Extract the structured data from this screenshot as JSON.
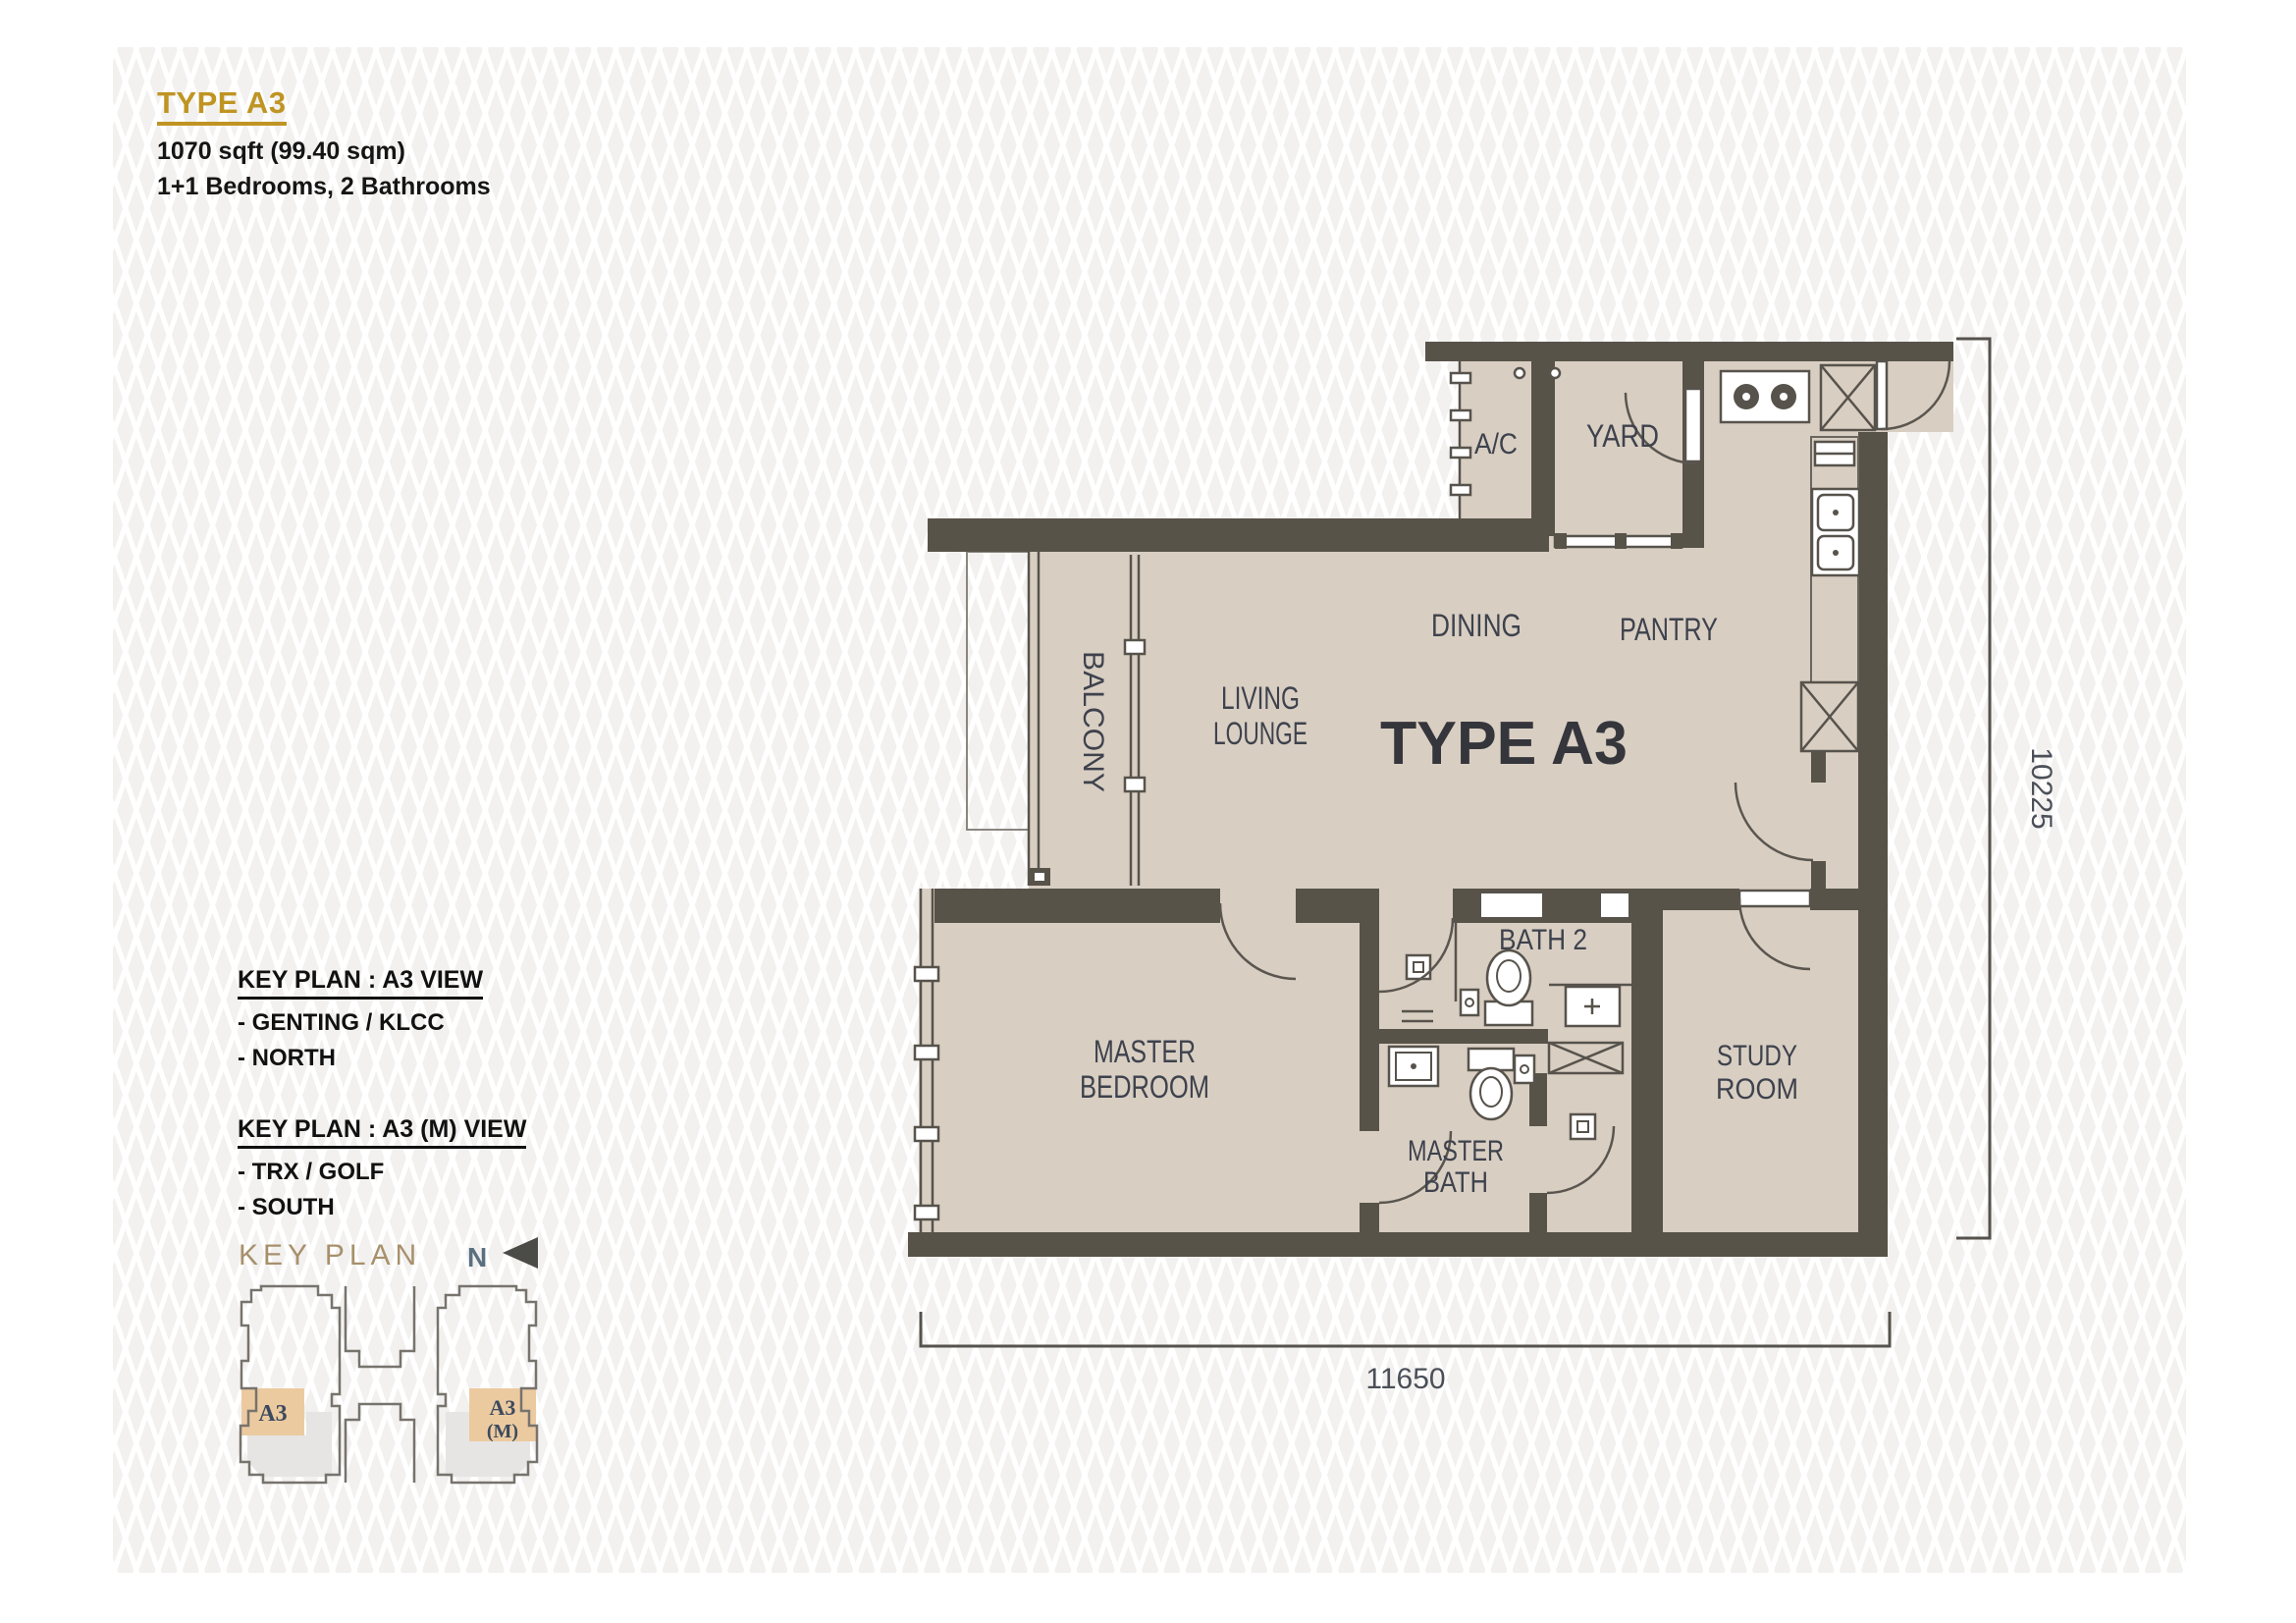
{
  "header": {
    "title": "TYPE A3",
    "area": "1070 sqft (99.40 sqm)",
    "rooms": "1+1 Bedrooms, 2 Bathrooms"
  },
  "views": [
    {
      "title": "KEY PLAN : A3 VIEW",
      "line1": "- GENTING / KLCC",
      "line2": "- NORTH"
    },
    {
      "title": "KEY PLAN : A3 (M) VIEW",
      "line1": "- TRX / GOLF",
      "line2": "- SOUTH"
    }
  ],
  "key_plan": {
    "title": "KEY PLAN",
    "north_label": "N",
    "unit_a3": "A3",
    "unit_a3m_line1": "A3",
    "unit_a3m_line2": "(M)"
  },
  "plan": {
    "plan_title": "TYPE A3",
    "labels": {
      "ac": "A/C",
      "yard": "YARD",
      "dining": "DINING",
      "pantry": "PANTRY",
      "living1": "LIVING",
      "living2": "LOUNGE",
      "balcony": "BALCONY",
      "bath2": "BATH 2",
      "master1": "MASTER",
      "master2": "BEDROOM",
      "mbath1": "MASTER",
      "mbath2": "BATH",
      "study1": "STUDY",
      "study2": "ROOM"
    },
    "dimensions": {
      "height_mm": "10225",
      "width_mm": "11650"
    }
  },
  "icons": {
    "north_arrow": "left-pointing-triangle"
  },
  "colors": {
    "accent_gold": "#bf9422",
    "wall": "#585349",
    "floor": "#d8cec2",
    "room_label": "#3e424d",
    "keyplan_unit_fill": "#eccaa0",
    "keyplan_title": "#a8906c",
    "pattern_base": "#f2f1ef"
  }
}
